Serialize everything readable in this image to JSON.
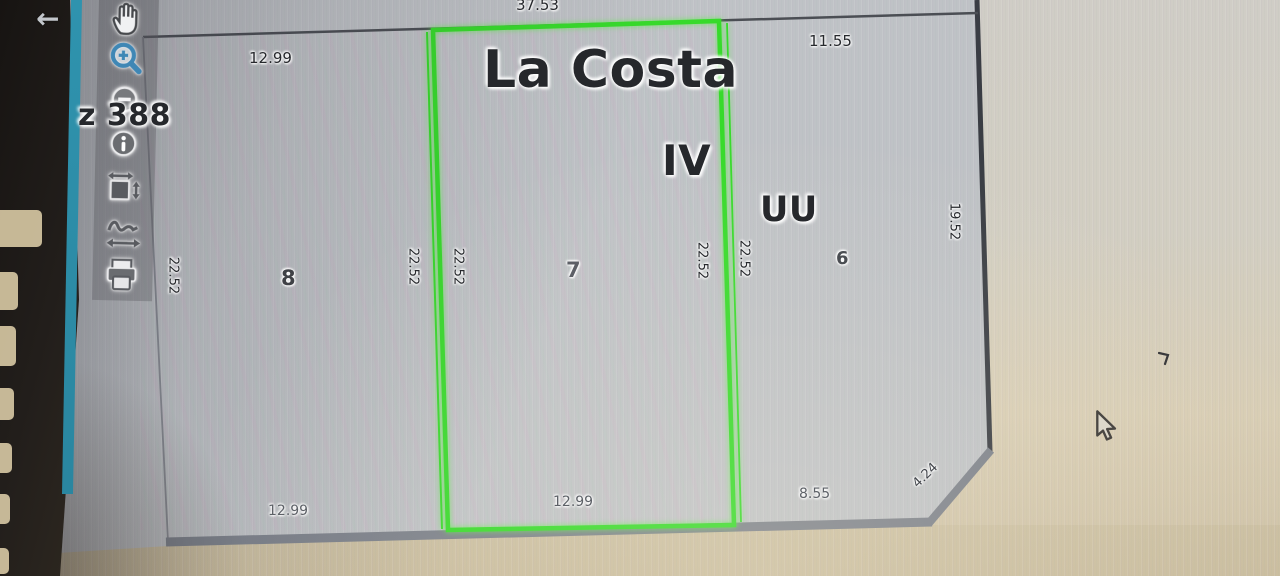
{
  "device": {
    "back_icon": "←"
  },
  "toolbar": {
    "tools": [
      {
        "name": "pan"
      },
      {
        "name": "zoom-in"
      },
      {
        "name": "zoom-out"
      },
      {
        "name": "identify-info"
      },
      {
        "name": "zoom-extent"
      },
      {
        "name": "measure"
      },
      {
        "name": "print"
      }
    ]
  },
  "map": {
    "title": "La Costa",
    "section_label": "IV",
    "zone_label": "UU",
    "block_label": "z 388",
    "parcels": [
      {
        "number": "8",
        "selected": false
      },
      {
        "number": "7",
        "selected": true
      },
      {
        "number": "6",
        "selected": false
      }
    ],
    "dim_labels": [
      {
        "text": "37.53",
        "role": "top-width"
      },
      {
        "text": "12.99",
        "role": "top-left-width"
      },
      {
        "text": "11.55",
        "role": "top-right-width"
      },
      {
        "text": "22.52",
        "role": "side-parcel8-left"
      },
      {
        "text": "22.52",
        "role": "side-parcel8-right"
      },
      {
        "text": "22.52",
        "role": "side-parcel7-left"
      },
      {
        "text": "22.52",
        "role": "side-parcel7-right"
      },
      {
        "text": "22.52",
        "role": "side-parcel6-left"
      },
      {
        "text": "19.52",
        "role": "right-side"
      },
      {
        "text": "12.99",
        "role": "bottom-parcel7"
      },
      {
        "text": "8.55",
        "role": "bottom-right"
      },
      {
        "text": "4.24",
        "role": "chamfer"
      },
      {
        "text": "12.99",
        "role": "bottom-left"
      }
    ],
    "colors": {
      "selection_green": "#37da2b",
      "boundary_gray": "#7c818b",
      "screen_edge_teal": "#2f93ae"
    }
  }
}
